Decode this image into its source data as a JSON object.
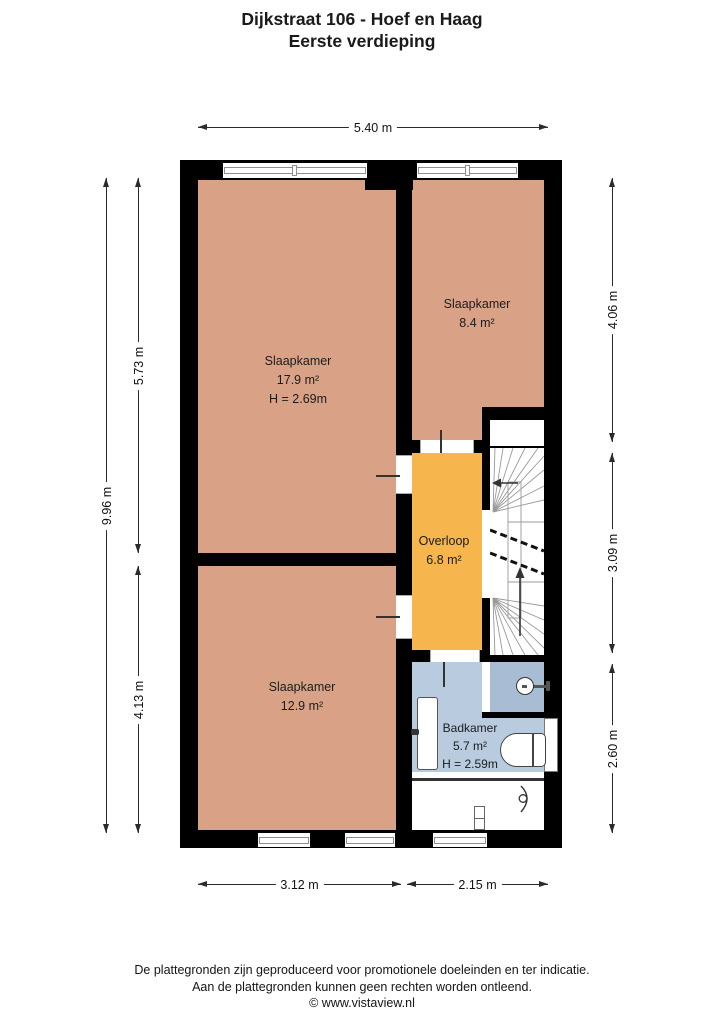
{
  "title": {
    "line1": "Dijkstraat 106 - Hoef en Haag",
    "line2": "Eerste verdieping"
  },
  "rooms": [
    {
      "name": "Slaapkamer",
      "area": "17.9 m²",
      "ceiling_height": "H = 2.69m"
    },
    {
      "name": "Slaapkamer",
      "area": "8.4 m²"
    },
    {
      "name": "Slaapkamer",
      "area": "12.9 m²"
    },
    {
      "name": "Overloop",
      "area": "6.8 m²"
    },
    {
      "name": "Badkamer",
      "area": "5.7 m²",
      "ceiling_height": "H = 2.59m"
    }
  ],
  "dimensions": {
    "top": "5.40 m",
    "left_outer": "9.96 m",
    "left_upper": "5.73 m",
    "left_lower": "4.13 m",
    "right_upper": "4.06 m",
    "right_middle": "3.09 m",
    "right_lower": "2.60 m",
    "bottom_left": "3.12 m",
    "bottom_right": "2.15 m"
  },
  "footer": {
    "line1": "De plattegronden zijn geproduceerd voor promotionele doeleinden en ter indicatie.",
    "line2": "Aan de plattegronden kunnen geen rechten worden ontleend.",
    "line3": "© www.vistaview.nl"
  },
  "colors": {
    "wall": "#000000",
    "room": "#d9a286",
    "landing": "#f7b54e",
    "bath": "#b8cbdf",
    "shower": "#a8bdd3",
    "winframe": "#8f8f8f",
    "dimension": "#2b2b2b"
  }
}
